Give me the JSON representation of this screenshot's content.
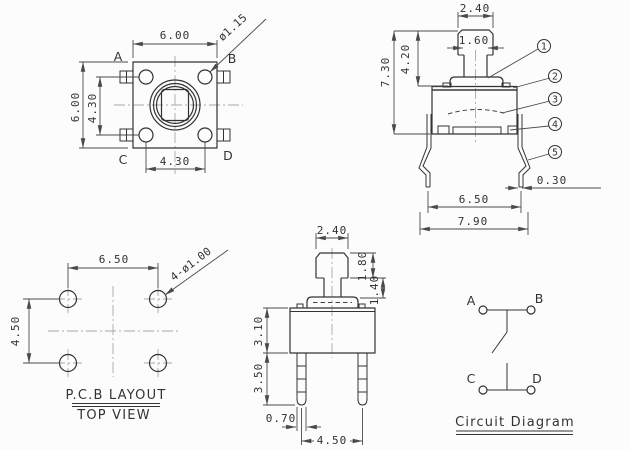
{
  "drawing": {
    "colors": {
      "background": "#fcfcfc",
      "line": "#333333",
      "dimension": "#4a4a4a",
      "centerline": "#a8a8a8"
    },
    "top_view": {
      "body_width": "6.00",
      "body_height": "6.00",
      "pin_row_span": "4.30",
      "pin_col_span": "4.30",
      "pin_diameter": "ø1.15",
      "pin_a": "A",
      "pin_b": "B",
      "pin_c": "C",
      "pin_d": "D"
    },
    "side_view": {
      "cap_width": "2.40",
      "stem_width": "1.60",
      "stem_height": "4.20",
      "total_height": "7.30",
      "lead_thickness": "0.30",
      "lead_tip_span": "6.50",
      "overall_width": "7.90",
      "callouts": [
        "1",
        "2",
        "3",
        "4",
        "5"
      ]
    },
    "pcb_layout": {
      "hole_span_h": "6.50",
      "hole_span_v": "4.50",
      "hole_note": "4-ø1.00",
      "caption_line1": "P.C.B LAYOUT",
      "caption_line2": "TOP VIEW"
    },
    "front_view": {
      "cap_width": "2.40",
      "cap_height": "1.80",
      "stem_height": "1.40",
      "body_height": "3.10",
      "lead_length": "3.50",
      "lead_width": "0.70",
      "lead_span": "4.50"
    },
    "circuit": {
      "term_a": "A",
      "term_b": "B",
      "term_c": "C",
      "term_d": "D",
      "caption": "Circuit Diagram"
    }
  }
}
